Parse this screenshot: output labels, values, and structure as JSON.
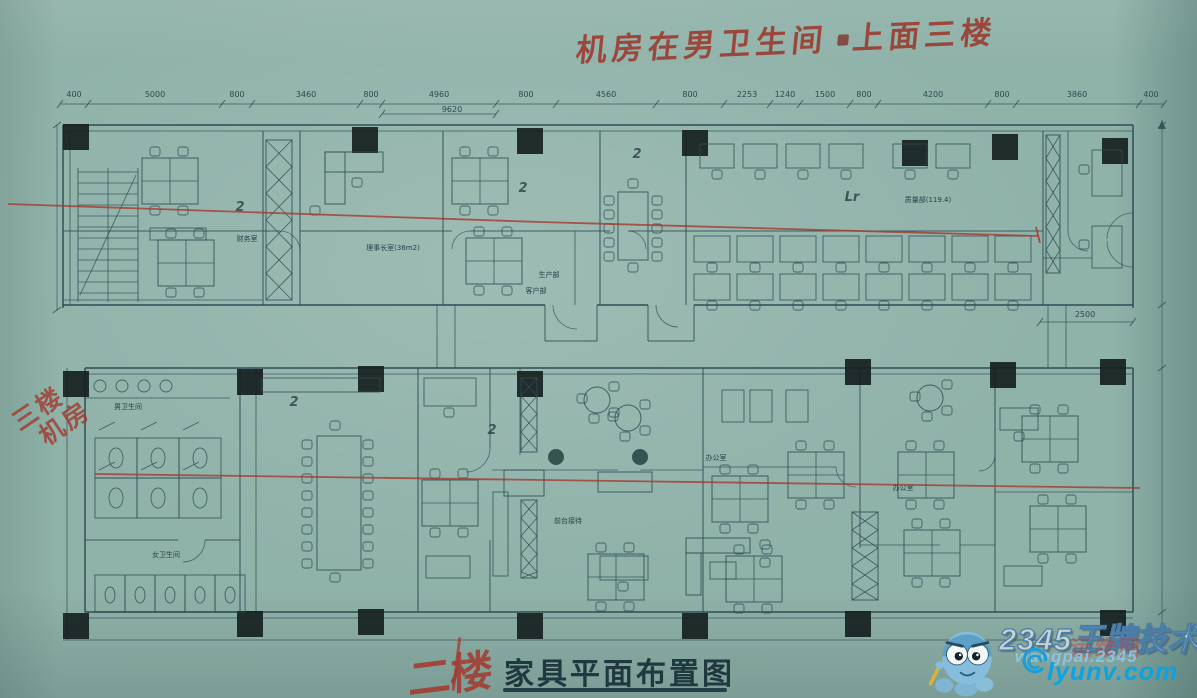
{
  "annotations": {
    "top_note_left": "机房在男卫生间",
    "top_note_right": "上面三楼",
    "left_note_line1": "三楼",
    "left_note_line2": "机房",
    "pen_color": "#a23a2e"
  },
  "title": {
    "floor_handwritten": "二楼",
    "main": "家具平面布置图"
  },
  "watermark": {
    "brand": "2345王牌技术",
    "url": "wangpai.2345",
    "site": "lyunv.com",
    "stamp": "运维网",
    "brand_color": "#c8d2d4",
    "site_color": "#0da2e0",
    "mascot": "octopus-mascot"
  },
  "plan": {
    "ink_color": "#2e4d55",
    "red_pen_color": "#a83a30",
    "paper_color": "#8fb2a9",
    "dims_top": [
      {
        "v": "400",
        "x": 74
      },
      {
        "v": "5000",
        "x": 155
      },
      {
        "v": "800",
        "x": 237
      },
      {
        "v": "3460",
        "x": 306
      },
      {
        "v": "800",
        "x": 371
      },
      {
        "v": "4960",
        "x": 439
      },
      {
        "v": "800",
        "x": 526
      },
      {
        "v": "4560",
        "x": 606
      },
      {
        "v": "800",
        "x": 690
      },
      {
        "v": "2253",
        "x": 747
      },
      {
        "v": "1240",
        "x": 785
      },
      {
        "v": "1500",
        "x": 825
      },
      {
        "v": "800",
        "x": 864
      },
      {
        "v": "4200",
        "x": 933
      },
      {
        "v": "800",
        "x": 1002
      },
      {
        "v": "3860",
        "x": 1077
      },
      {
        "v": "400",
        "x": 1151
      }
    ],
    "dim_sub": {
      "v": "9620",
      "x": 452
    },
    "dim_2500": {
      "v": "2500",
      "x": 1085
    },
    "rooms": [
      {
        "t": "财务室",
        "x": 247,
        "y": 241
      },
      {
        "t": "理事长室(36m2)",
        "x": 393,
        "y": 250
      },
      {
        "t": "生产部",
        "x": 549,
        "y": 277
      },
      {
        "t": "客户部",
        "x": 536,
        "y": 293
      },
      {
        "t": "质量部(119.4)",
        "x": 928,
        "y": 202
      },
      {
        "t": "男卫生间",
        "x": 128,
        "y": 409
      },
      {
        "t": "女卫生间",
        "x": 166,
        "y": 557
      },
      {
        "t": "前台接待",
        "x": 568,
        "y": 523
      },
      {
        "t": "办公室",
        "x": 716,
        "y": 460
      },
      {
        "t": "办公室",
        "x": 903,
        "y": 490
      }
    ],
    "pen_marks": [
      {
        "t": "2",
        "x": 240,
        "y": 211
      },
      {
        "t": "2",
        "x": 523,
        "y": 192
      },
      {
        "t": "2",
        "x": 637,
        "y": 158
      },
      {
        "t": "2",
        "x": 294,
        "y": 406
      },
      {
        "t": "2",
        "x": 492,
        "y": 434
      },
      {
        "t": "Lr",
        "x": 852,
        "y": 201
      }
    ]
  }
}
